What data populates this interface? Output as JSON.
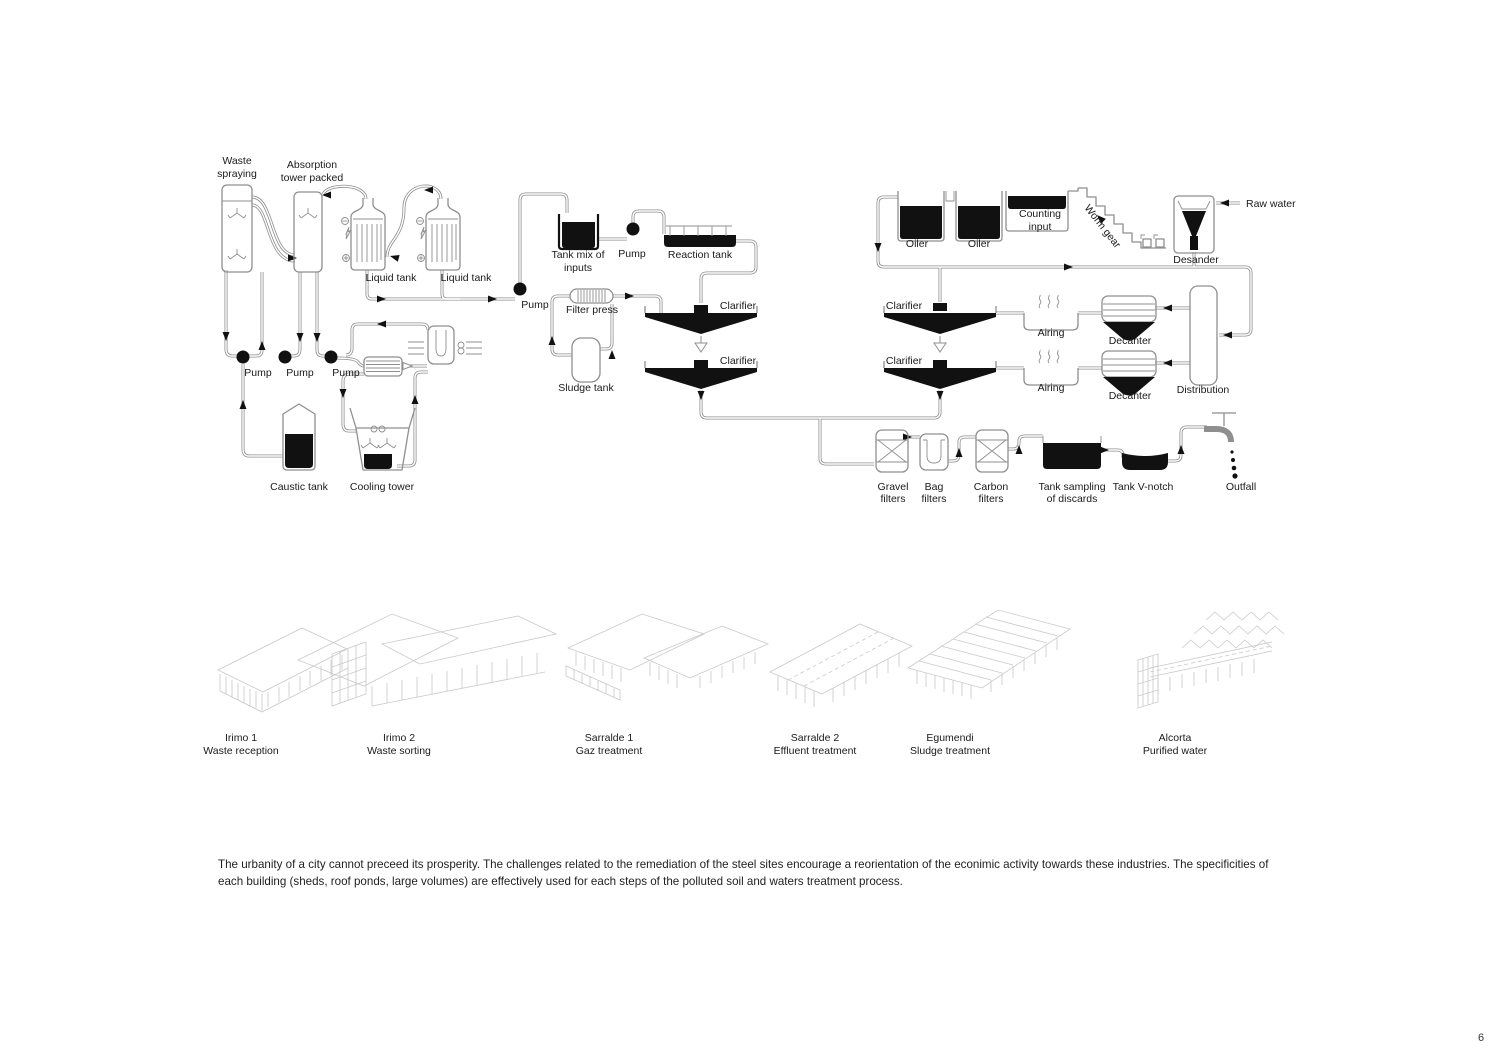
{
  "page_number": "6",
  "caption": "The urbanity of a city cannot preceed its prosperity. The challenges related to the remediation of the steel sites  encourage a reorientation of the econimic activity towards these industries. The specificities of each building (sheds, roof ponds, large volumes) are effectively used for each steps of the polluted soil and waters treatment process.",
  "colors": {
    "pipe": "#8f8f8f",
    "ink": "#111111",
    "label": "#1a1a1a",
    "building_sketch": "#c9c9c9",
    "background": "#ffffff"
  },
  "labels": {
    "waste_spraying_l1": "Waste",
    "waste_spraying_l2": "spraying",
    "absorption_l1": "Absorption",
    "absorption_l2": "tower packed",
    "liquid_tank": "Liquid tank",
    "pump": "Pump",
    "caustic_tank": "Caustic tank",
    "cooling_tower": "Cooling tower",
    "tank_mix_l1": "Tank mix of",
    "tank_mix_l2": "inputs",
    "reaction_tank": "Reaction tank",
    "filter_press": "Filter press",
    "sludge_tank": "Sludge tank",
    "clarifier": "Clarifier",
    "oiler": "Oiler",
    "counting_l1": "Counting",
    "counting_l2": "input",
    "worm_gear": "Worm gear",
    "desander": "Desander",
    "raw_water": "Raw water",
    "airing": "Airing",
    "decanter": "Decanter",
    "distribution": "Distribution",
    "gravel_l1": "Gravel",
    "gravel_l2": "filters",
    "bag_l1": "Bag",
    "bag_l2": "filters",
    "carbon_l1": "Carbon",
    "carbon_l2": "filters",
    "sampling_l1": "Tank sampling",
    "sampling_l2": "of discards",
    "v_notch": "Tank V-notch",
    "outfall": "Outfall"
  },
  "buildings": [
    {
      "name": "Irimo 1",
      "function": "Waste reception"
    },
    {
      "name": "Irimo 2",
      "function": "Waste sorting"
    },
    {
      "name": "Sarralde 1",
      "function": "Gaz treatment"
    },
    {
      "name": "Sarralde 2",
      "function": "Effluent treatment"
    },
    {
      "name": "Egumendi",
      "function": "Sludge treatment"
    },
    {
      "name": "Alcorta",
      "function": "Purified water"
    }
  ]
}
